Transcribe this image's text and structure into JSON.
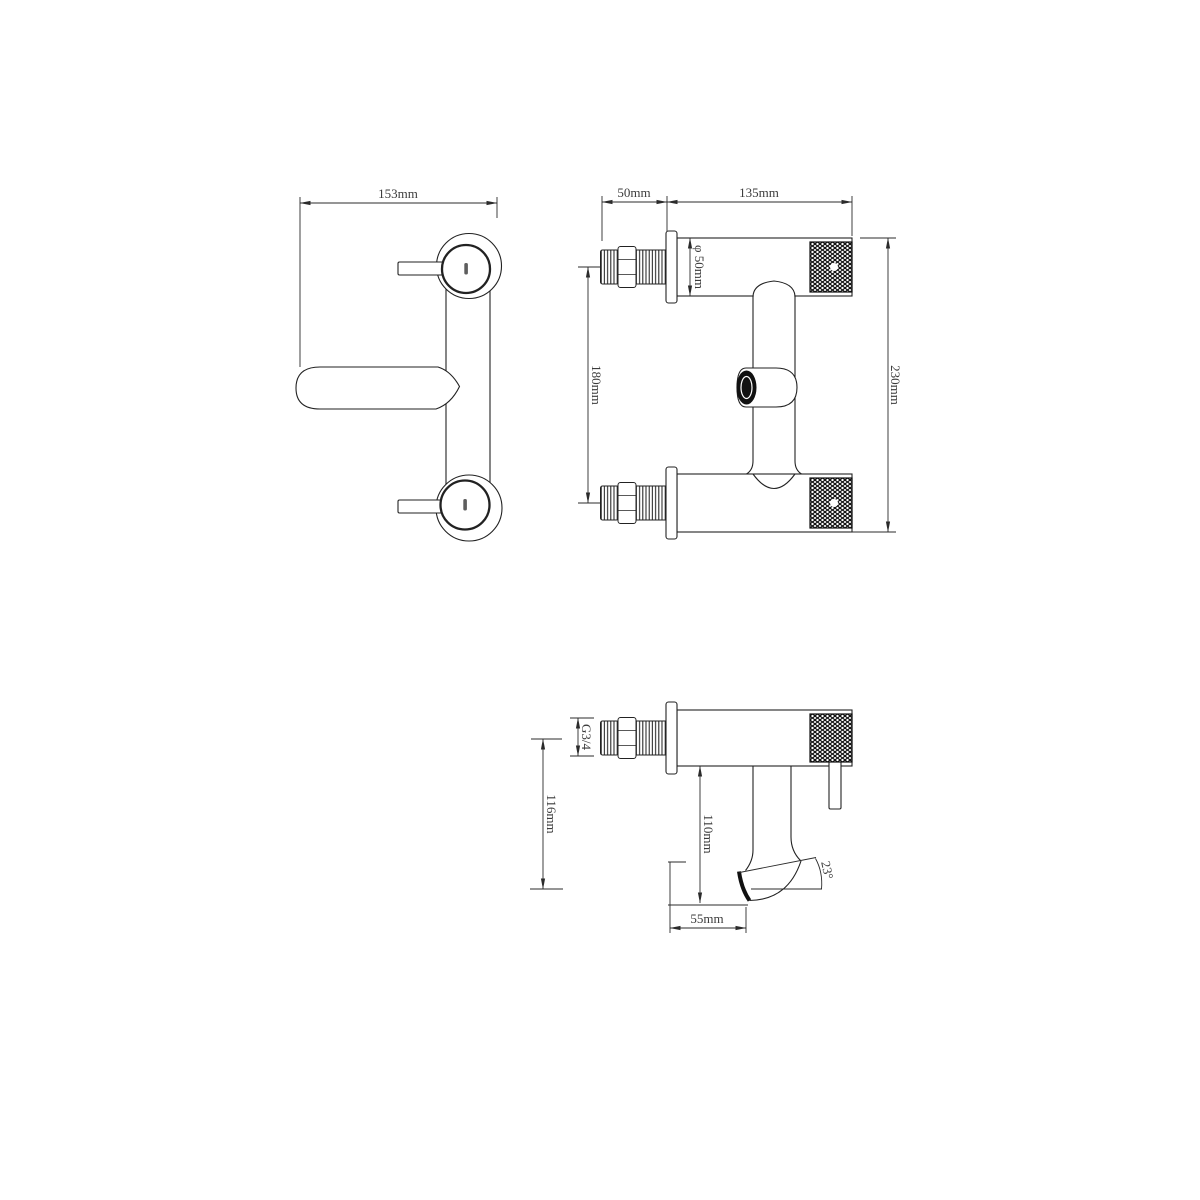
{
  "views": {
    "front": {
      "overall_width": "153mm"
    },
    "side": {
      "thread_length": "50mm",
      "body_length": "135mm",
      "body_diameter": "φ 50mm",
      "inlet_spacing": "180mm",
      "overall_height": "230mm"
    },
    "spout_profile": {
      "thread_size": "G3/4",
      "axis_to_outlet": "116mm",
      "spout_drop": "110mm",
      "spout_reach": "55mm",
      "spout_angle": "23°"
    }
  },
  "colors": {
    "line": "#222222",
    "dim_line": "#2b2b2b",
    "dim_text": "#3b3b3b",
    "background": "#ffffff"
  }
}
